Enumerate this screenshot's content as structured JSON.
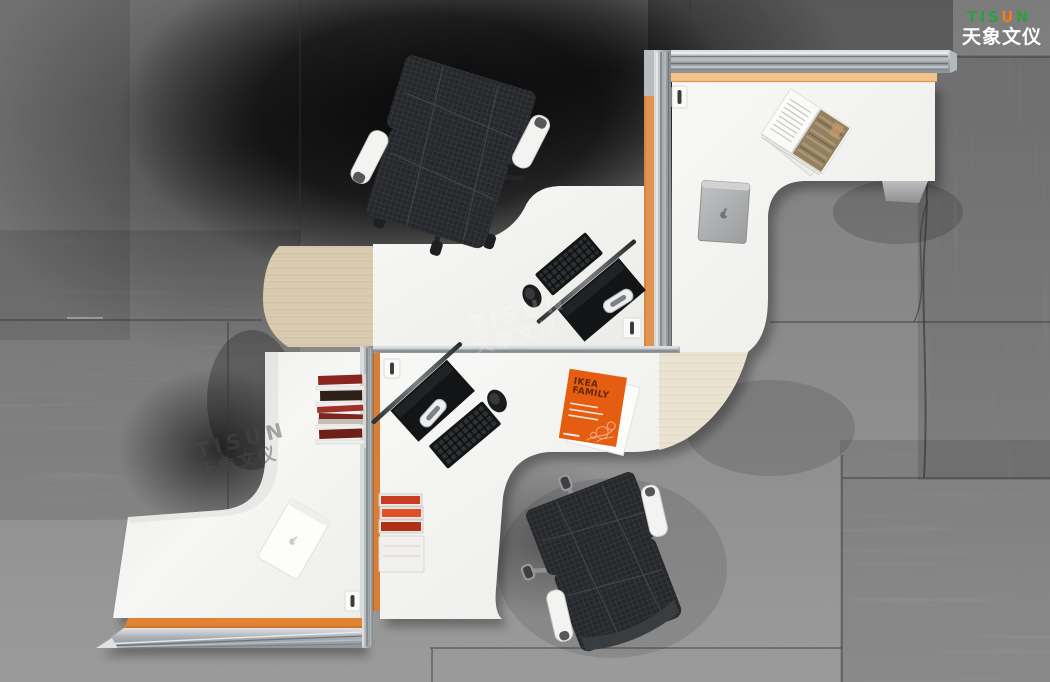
{
  "brand": {
    "name": "TISUN",
    "letters": [
      {
        "ch": "T",
        "color": "#2e9e3e"
      },
      {
        "ch": "I",
        "color": "#2e9e3e"
      },
      {
        "ch": "S",
        "color": "#2e9e3e"
      },
      {
        "ch": "U",
        "color": "#f07d1d"
      },
      {
        "ch": "N",
        "color": "#2e9e3e"
      }
    ],
    "subtitle": "天象文仪",
    "subtitle_color": "#ffffff"
  },
  "watermark": {
    "line1": "TISUN",
    "line2": "天象文仪"
  },
  "brochure": {
    "title_line1": "IKEA",
    "title_line2": "FAMILY",
    "cover_color": "#e55d11",
    "title_color": "#63280a"
  },
  "palette": {
    "floor_base": "#8d8d8d",
    "floor_dark": "#161616",
    "floor_light": "#a9a9a9",
    "desk_white": "#f5f5f3",
    "wood_tan": "#dbccb1",
    "wood_pale": "#ebe3d3",
    "aluminum": "#c4c8ca",
    "accent_orange": "#d97e35",
    "accent_orange_pale": "#f3c38b",
    "accent_red": "#c23b20",
    "chair_mesh": "#27292c",
    "chrome": "#b9bcbe"
  },
  "objects": {
    "chair_top": "mesh-office-chair",
    "chair_bottom": "mesh-office-chair",
    "laptop_gray": "gray-laptop-closed",
    "laptop_white": "white-laptop-closed",
    "magazine_open": "open-magazine",
    "brochure": "orange-brochure",
    "monitor_upper": "flat-monitor",
    "monitor_lower": "flat-monitor",
    "keyboard_upper": "black-keyboard",
    "keyboard_lower": "black-keyboard",
    "mouse_upper": "black-mouse",
    "mouse_lower": "black-mouse",
    "magazine_rack": "side-magazine-rack",
    "letter_trays": "red-letter-trays",
    "grommet": "cable-grommet"
  }
}
